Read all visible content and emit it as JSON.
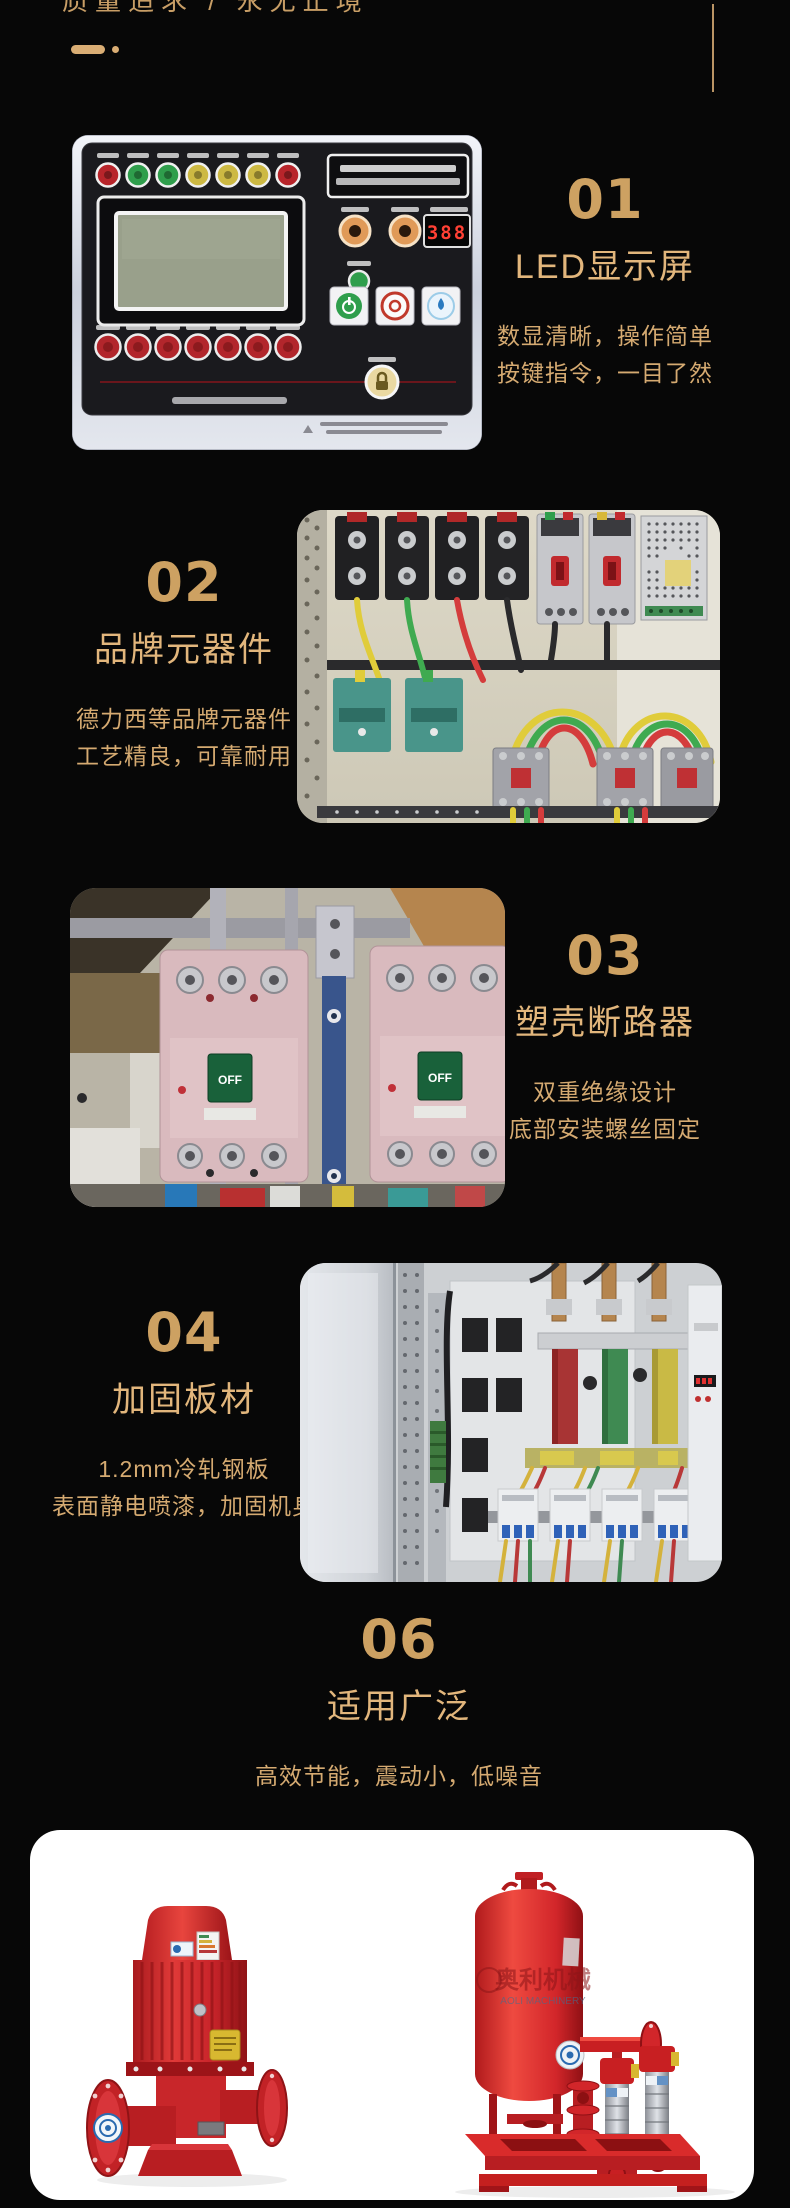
{
  "page": {
    "tagline": "质量追求 / 永无止境"
  },
  "features": {
    "s01": {
      "number": "01",
      "title": "LED显示屏",
      "desc1": "数显清晰，操作简单",
      "desc2": "按键指令，一目了然"
    },
    "s02": {
      "number": "02",
      "title": "品牌元器件",
      "desc1": "德力西等品牌元器件",
      "desc2": "工艺精良，可靠耐用"
    },
    "s03": {
      "number": "03",
      "title": "塑壳断路器",
      "desc1": "双重绝缘设计",
      "desc2": "底部安装螺丝固定"
    },
    "s04": {
      "number": "04",
      "title": "加固板材",
      "desc1": "1.2mm冷轧钢板",
      "desc2": "表面静电喷漆，加固机身"
    },
    "s06": {
      "number": "06",
      "title": "适用广泛",
      "desc1": "高效节能，震动小，低噪音"
    }
  },
  "photos": {
    "control_panel": {
      "display_value": "388"
    },
    "breakers": {
      "switch_label": "OFF"
    },
    "pump_set": {
      "watermark_cn": "奥利机械",
      "watermark_en": "AOLI MACHINERY"
    }
  },
  "colors": {
    "gold": "#d2a76e",
    "background": "#070707",
    "pump_red": "#d2262a",
    "panel_white": "#ffffff"
  }
}
